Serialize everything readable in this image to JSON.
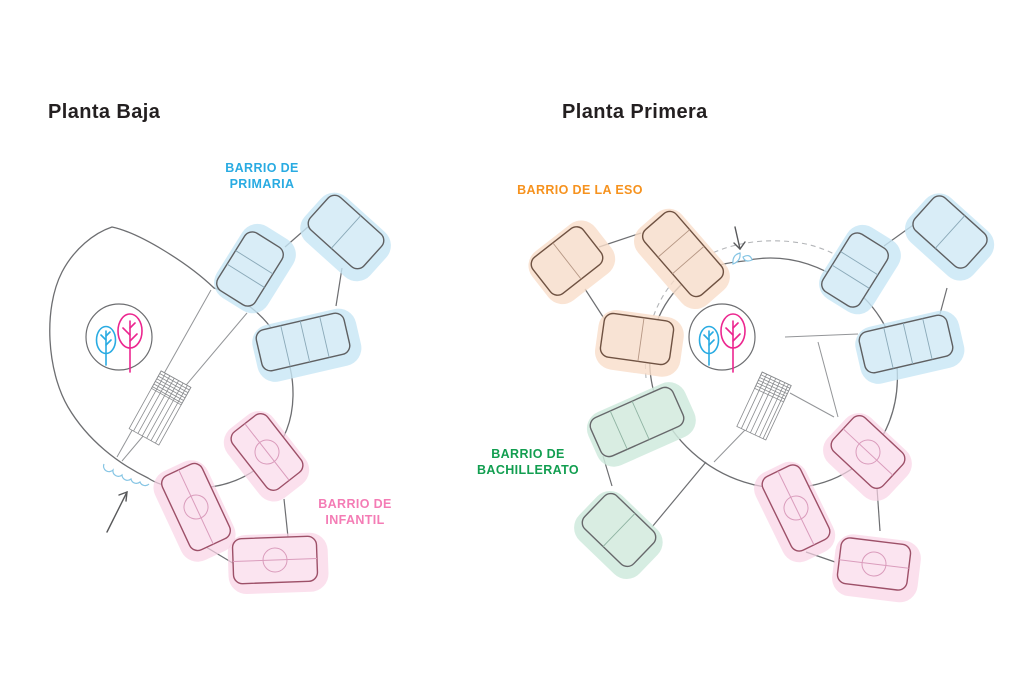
{
  "page": {
    "background_color": "#ffffff",
    "type": "school-floor-plan-diagram"
  },
  "panels": [
    {
      "title": "Planta Baja",
      "labels": [
        {
          "text": "BARRIO DE PRIMARIA",
          "color": "#29abe2"
        },
        {
          "text": "BARRIO DE INFANTIL",
          "color": "#f47cb5"
        }
      ]
    },
    {
      "title": "Planta Primera",
      "labels": [
        {
          "text": "BARRIO DE LA ESO",
          "color": "#f6921e"
        },
        {
          "text": "BARRIO DE BACHILLERATO",
          "color": "#129e50"
        }
      ]
    }
  ],
  "palette": {
    "title_text": "#231f20",
    "outline_gray": "#6d6e71",
    "blue_room_fill": "#d9edf7",
    "blue_room_halo": "#c7e6f5",
    "pink_room_fill": "#fbe4f0",
    "pink_room_stroke": "#9d5068",
    "pink_room_halo": "#f9d3e6",
    "orange_room_fill": "#f8e3d4",
    "orange_room_stroke": "#6f5242",
    "orange_room_halo": "#f9ddc9",
    "green_room_fill": "#d9ede2",
    "green_room_halo": "#cfeadd",
    "tree_blue": "#29abe2",
    "tree_pink": "#ec268f",
    "dashed_path": "#b3b5b8",
    "entrance_mark_blue": "#86c5e4",
    "arrow_gray": "#58595b"
  }
}
